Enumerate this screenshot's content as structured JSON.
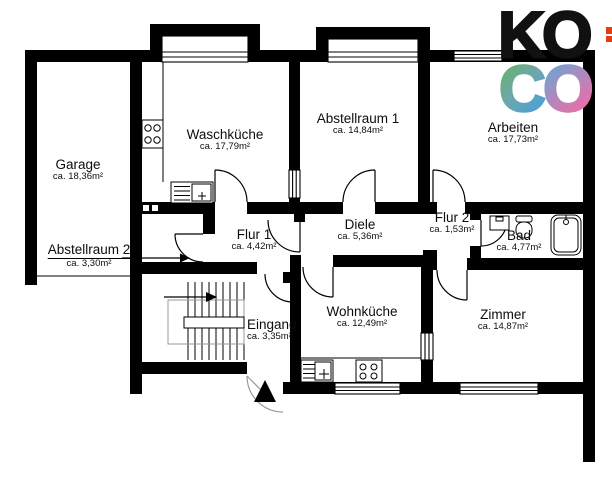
{
  "background": "#ffffff",
  "plan": {
    "wall_color": "#000000",
    "rooms": [
      {
        "id": "garage",
        "name": "Garage",
        "area": "ca. 18,36m²"
      },
      {
        "id": "waschkueche",
        "name": "Waschküche",
        "area": "ca. 17,79m²"
      },
      {
        "id": "abstellraum-1",
        "name": "Abstellraum 1",
        "area": "ca. 14,84m²"
      },
      {
        "id": "arbeiten",
        "name": "Arbeiten",
        "area": "ca. 17,73m²"
      },
      {
        "id": "flur-1",
        "name": "Flur 1",
        "area": "ca. 4,42m²"
      },
      {
        "id": "diele",
        "name": "Diele",
        "area": "ca. 5,36m²"
      },
      {
        "id": "flur-2",
        "name": "Flur 2",
        "area": "ca. 1,53m²"
      },
      {
        "id": "bad",
        "name": "Bad",
        "area": "ca. 4,77m²"
      },
      {
        "id": "abstellraum-2",
        "name": "Abstellraum 2",
        "area": "ca. 3,30m²"
      },
      {
        "id": "eingang",
        "name": "Eingang",
        "area": "ca. 3,35m²"
      },
      {
        "id": "wohnkueche",
        "name": "Wohnküche",
        "area": "ca. 12,49m²"
      },
      {
        "id": "zimmer",
        "name": "Zimmer",
        "area": "ca. 14,87m²"
      }
    ],
    "symbols": [
      "bay-window",
      "window",
      "door-swing",
      "stairs",
      "stairs-direction-arrow",
      "entrance-arrow",
      "stove-hob",
      "kitchen-sink",
      "washbasin",
      "toilet",
      "bathtub",
      "garage-door-line",
      "label-pointer-arrow"
    ]
  },
  "logo": {
    "ko": "KO",
    "c": "C",
    "o2": "O",
    "colors": {
      "ko": "#111111",
      "c_gradient": [
        "#5fb84b",
        "#6fa7ab",
        "#4aa0d8"
      ],
      "o_gradient": [
        "#3eb5e4",
        "#9a92c4",
        "#f16ba6"
      ]
    }
  },
  "edge_mark": {
    "color": "#e63c0e"
  }
}
